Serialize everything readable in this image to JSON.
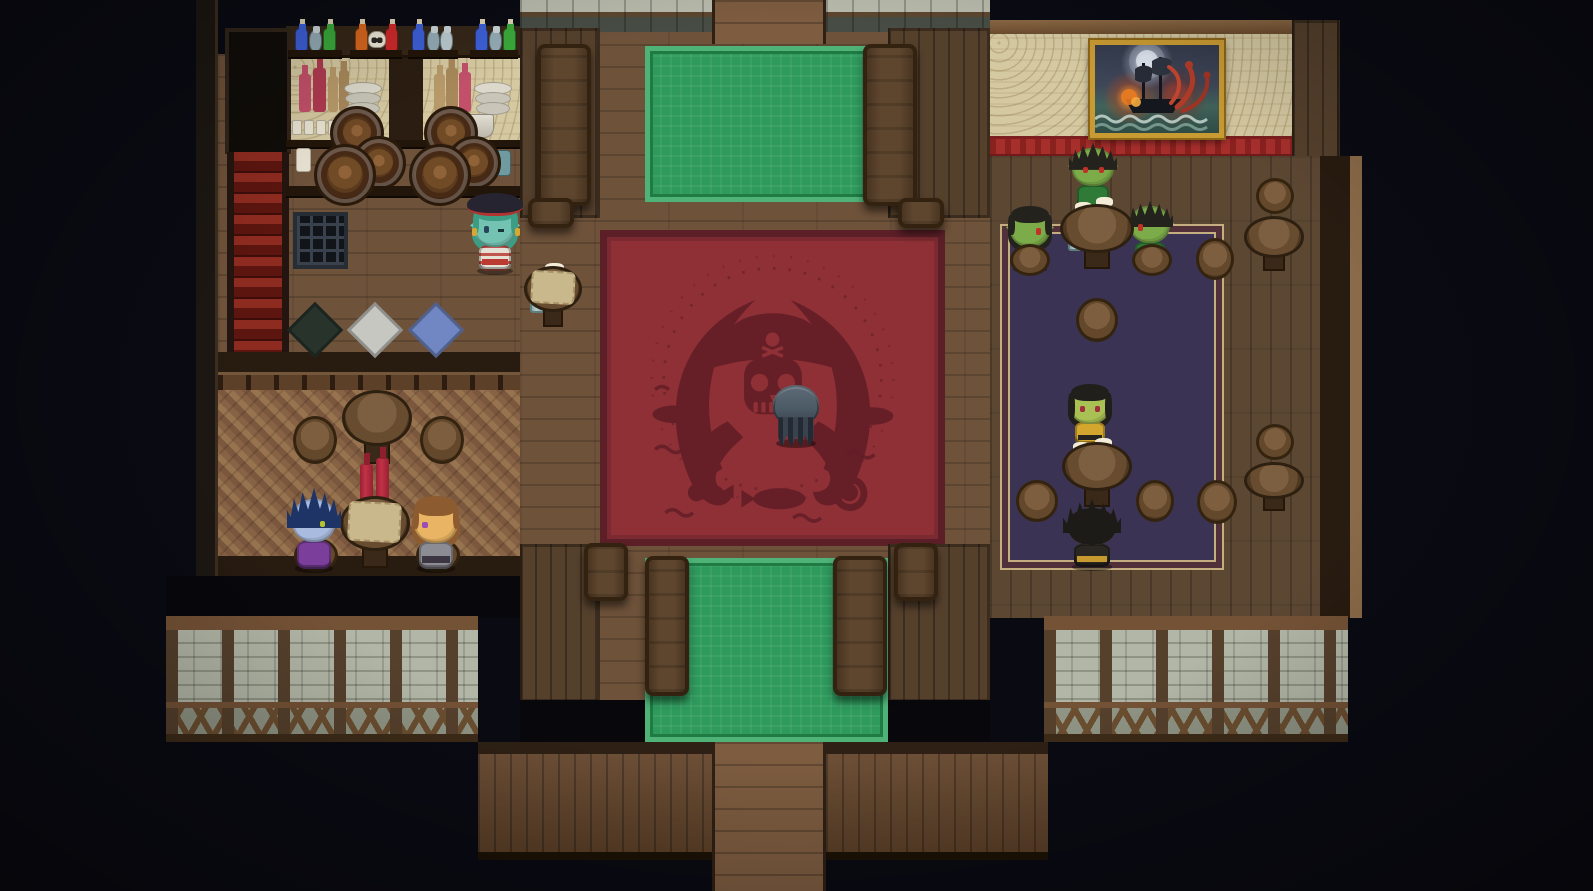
{
  "scene": {
    "setting": "pirate tavern interior",
    "style": "top-down 16-bit RPG pixel art",
    "width": 1593,
    "height": 891
  },
  "palette": {
    "background": "#0a0a13",
    "hall_floor": "#6e523a",
    "right_room_floor": "#5c4733",
    "wall_plank": "#55402c",
    "parquet": "#8a6545",
    "carpet_green": "#2e9a5c",
    "carpet_green_border": "#4fb277",
    "carpet_red": "#8e3036",
    "carpet_red_motif": "#621d26",
    "carpet_purple": "#3b3353",
    "carpet_purple_trim": "#c4ad7f",
    "wallpaper_tan": "#d5c9a2",
    "red_stripe": "#a62f2c",
    "stone_wall": "#a9ae9e",
    "stairs_red": "#8e2b20",
    "gold_frame": "#c89a32",
    "mug_body": "#9bb7b9",
    "mug_foam": "#f2ecd8"
  },
  "carpets": {
    "red_rug_motif": "pirate skull wearing a tricorn hat over crossed cutlasses, surrounded by tentacles, fish and waves",
    "green_rugs": "two ornate green runner rugs under the long mess tables",
    "purple_rug": "dark violet rug with tan double border in the goblin taproom"
  },
  "right_room": {
    "painting": {
      "subject": "galleon attacked by a red kraken on a stormy night sea",
      "frame": "#c89a32",
      "x": 1090,
      "y": 40,
      "w": 134,
      "h": 98
    }
  },
  "regions": [
    {
      "name": "hall-floor",
      "cls": "floor-h",
      "x": 520,
      "y": 0,
      "w": 470,
      "h": 744
    },
    {
      "name": "hall-walkway-top",
      "cls": "walkway",
      "x": 712,
      "y": 0,
      "w": 114,
      "h": 44,
      "inter": true
    },
    {
      "name": "stone-ledge-left",
      "cls": "stonetop",
      "x": 520,
      "y": 0,
      "w": 192,
      "h": 32
    },
    {
      "name": "stone-ledge-right",
      "cls": "stonetop",
      "x": 826,
      "y": 0,
      "w": 164,
      "h": 32
    },
    {
      "name": "hall-wall-top-left",
      "cls": "wallv",
      "x": 520,
      "y": 28,
      "w": 80,
      "h": 190
    },
    {
      "name": "hall-wall-top-right",
      "cls": "wallv",
      "x": 888,
      "y": 28,
      "w": 102,
      "h": 190
    },
    {
      "name": "green-carpet-top",
      "cls": "carpet-green",
      "x": 645,
      "y": 46,
      "w": 240,
      "h": 156
    },
    {
      "name": "left-room-floor",
      "cls": "floor-h",
      "x": 218,
      "y": 54,
      "w": 302,
      "h": 302
    },
    {
      "name": "bar-wallpaper",
      "cls": "wallpaper",
      "x": 286,
      "y": 58,
      "w": 234,
      "h": 88
    },
    {
      "name": "bar-pillar",
      "cls": "darkwood",
      "x": 389,
      "y": 56,
      "w": 34,
      "h": 92
    },
    {
      "name": "potion-shelf",
      "cls": "shelfdark",
      "x": 286,
      "y": 26,
      "w": 234,
      "h": 32
    },
    {
      "name": "left-edge-beam",
      "cls": "framedark",
      "x": 196,
      "y": 0,
      "w": 22,
      "h": 618
    },
    {
      "name": "stairs-doorway",
      "cls": "doorway",
      "x": 225,
      "y": 28,
      "w": 66,
      "h": 126,
      "inter": true
    },
    {
      "name": "red-staircase",
      "cls": "stairs",
      "x": 227,
      "y": 152,
      "w": 62,
      "h": 222,
      "inter": true
    },
    {
      "name": "left-divider",
      "cls": "darkband",
      "x": 218,
      "y": 352,
      "w": 302,
      "h": 22
    },
    {
      "name": "left-railing",
      "cls": "railing",
      "x": 218,
      "y": 372,
      "w": 302,
      "h": 20
    },
    {
      "name": "parquet-floor",
      "cls": "parquet",
      "x": 218,
      "y": 390,
      "w": 302,
      "h": 172
    },
    {
      "name": "left-room-bottom",
      "cls": "darkband",
      "x": 218,
      "y": 556,
      "w": 302,
      "h": 22
    },
    {
      "name": "left-room-shadow",
      "cls": "blackout",
      "x": 166,
      "y": 576,
      "w": 354,
      "h": 42
    },
    {
      "name": "red-carpet",
      "cls": "carpet-red",
      "x": 600,
      "y": 230,
      "w": 345,
      "h": 316
    },
    {
      "name": "hall-wall-bottom-left",
      "cls": "wallv",
      "x": 520,
      "y": 544,
      "w": 80,
      "h": 158
    },
    {
      "name": "hall-wall-bottom-right",
      "cls": "wallv",
      "x": 888,
      "y": 544,
      "w": 102,
      "h": 158
    },
    {
      "name": "green-carpet-bottom",
      "cls": "carpet-green",
      "x": 645,
      "y": 558,
      "w": 243,
      "h": 184
    },
    {
      "name": "void-bottom-left",
      "cls": "blackout",
      "x": 520,
      "y": 700,
      "w": 125,
      "h": 44
    },
    {
      "name": "void-bottom-right",
      "cls": "blackout",
      "x": 888,
      "y": 700,
      "w": 102,
      "h": 44
    },
    {
      "name": "right-beam-top",
      "cls": "beam",
      "x": 990,
      "y": 20,
      "w": 340,
      "h": 16
    },
    {
      "name": "right-wallpaper",
      "cls": "wallpaper",
      "x": 990,
      "y": 34,
      "w": 302,
      "h": 104
    },
    {
      "name": "right-wood-corner",
      "cls": "wallv",
      "x": 1292,
      "y": 20,
      "w": 48,
      "h": 140
    },
    {
      "name": "right-red-stripe",
      "cls": "redstripe",
      "x": 990,
      "y": 136,
      "w": 302,
      "h": 22
    },
    {
      "name": "right-room-floor",
      "cls": "floor-v",
      "x": 990,
      "y": 156,
      "w": 330,
      "h": 462
    },
    {
      "name": "right-wall-edge",
      "cls": "darkband",
      "x": 1320,
      "y": 156,
      "w": 30,
      "h": 462
    },
    {
      "name": "right-edge-light",
      "cls": "framelight",
      "x": 1350,
      "y": 156,
      "w": 12,
      "h": 462
    },
    {
      "name": "purple-carpet",
      "cls": "carpet-purple",
      "x": 1000,
      "y": 224,
      "w": 224,
      "h": 346
    },
    {
      "name": "stone-wall-left",
      "cls": "stonewall",
      "x": 166,
      "y": 616,
      "w": 312,
      "h": 126
    },
    {
      "name": "stone-wall-right",
      "cls": "stonewall",
      "x": 1044,
      "y": 616,
      "w": 304,
      "h": 126
    },
    {
      "name": "plank-wall-left",
      "cls": "plankwall",
      "x": 478,
      "y": 742,
      "w": 234,
      "h": 118
    },
    {
      "name": "plank-wall-right",
      "cls": "plankwall",
      "x": 826,
      "y": 742,
      "w": 222,
      "h": 118
    },
    {
      "name": "exit-walkway",
      "cls": "walkway",
      "x": 712,
      "y": 742,
      "w": 114,
      "h": 149,
      "inter": true
    }
  ],
  "entities": [
    {
      "t": "board",
      "x": 288,
      "y": 50,
      "w": 54,
      "h": 9
    },
    {
      "t": "board",
      "x": 350,
      "y": 50,
      "w": 52,
      "h": 9
    },
    {
      "t": "board",
      "x": 408,
      "y": 50,
      "w": 50,
      "h": 9
    },
    {
      "t": "board",
      "x": 470,
      "y": 50,
      "w": 48,
      "h": 9
    },
    {
      "t": "potion",
      "x": 295,
      "y": 28,
      "c": "#3d5fd6"
    },
    {
      "t": "jug",
      "x": 309,
      "y": 30,
      "c": "#93aab4"
    },
    {
      "t": "potion",
      "x": 323,
      "y": 28,
      "c": "#3aa83a"
    },
    {
      "t": "potion",
      "x": 355,
      "y": 28,
      "c": "#d6661e"
    },
    {
      "t": "skull",
      "x": 368,
      "y": 31
    },
    {
      "t": "potion",
      "x": 385,
      "y": 28,
      "c": "#cc2a2a"
    },
    {
      "t": "potion",
      "x": 412,
      "y": 28,
      "c": "#3d5fd6"
    },
    {
      "t": "jug",
      "x": 427,
      "y": 30,
      "c": "#93aab4"
    },
    {
      "t": "jug",
      "x": 440,
      "y": 30,
      "c": "#b9c9cd"
    },
    {
      "t": "potion",
      "x": 475,
      "y": 28,
      "c": "#3d5fd6"
    },
    {
      "t": "jug",
      "x": 489,
      "y": 30,
      "c": "#93aab4"
    },
    {
      "t": "potion",
      "x": 503,
      "y": 28,
      "c": "#3aa83a"
    },
    {
      "t": "bottle",
      "x": 299,
      "y": 74,
      "w": 12,
      "h": 38,
      "c": "#c2506a"
    },
    {
      "t": "bottle",
      "x": 313,
      "y": 68,
      "w": 13,
      "h": 44,
      "c": "#b03a50"
    },
    {
      "t": "bottle",
      "x": 328,
      "y": 76,
      "w": 10,
      "h": 36,
      "c": "#b89a6a"
    },
    {
      "t": "bottle",
      "x": 339,
      "y": 70,
      "w": 10,
      "h": 42,
      "c": "#a8885a"
    },
    {
      "t": "plates",
      "x": 344,
      "y": 82,
      "w": 40,
      "h": 34
    },
    {
      "t": "bottle",
      "x": 434,
      "y": 74,
      "w": 11,
      "h": 38,
      "c": "#b89a6a"
    },
    {
      "t": "bottle",
      "x": 446,
      "y": 68,
      "w": 12,
      "h": 44,
      "c": "#a8885a"
    },
    {
      "t": "bottle",
      "x": 459,
      "y": 72,
      "w": 12,
      "h": 40,
      "c": "#c2506a"
    },
    {
      "t": "plates",
      "x": 474,
      "y": 82,
      "w": 40,
      "h": 34
    },
    {
      "t": "smug",
      "x": 292,
      "y": 120
    },
    {
      "t": "smug",
      "x": 304,
      "y": 120
    },
    {
      "t": "smug",
      "x": 316,
      "y": 120
    },
    {
      "t": "smug",
      "x": 328,
      "y": 120
    },
    {
      "t": "smug",
      "x": 340,
      "y": 120
    },
    {
      "t": "bucket",
      "x": 468,
      "y": 114,
      "w": 26,
      "h": 24
    },
    {
      "t": "board",
      "x": 286,
      "y": 140,
      "w": 234,
      "h": 9
    },
    {
      "t": "jar",
      "x": 296,
      "y": 148,
      "w": 15,
      "h": 24
    },
    {
      "t": "can",
      "x": 487,
      "y": 150,
      "w": 24,
      "h": 26,
      "c": "#6f9aa0"
    },
    {
      "t": "barrel",
      "x": 330,
      "y": 106,
      "s": 54
    },
    {
      "t": "barrel",
      "x": 424,
      "y": 106,
      "s": 54
    },
    {
      "t": "barrel",
      "x": 352,
      "y": 136,
      "s": 54
    },
    {
      "t": "barrel",
      "x": 447,
      "y": 136,
      "s": 54
    },
    {
      "t": "barrel",
      "x": 314,
      "y": 144,
      "s": 62
    },
    {
      "t": "barrel",
      "x": 409,
      "y": 144,
      "s": 62
    },
    {
      "t": "board",
      "x": 286,
      "y": 186,
      "w": 234,
      "h": 12
    },
    {
      "t": "grate",
      "x": 293,
      "y": 212,
      "w": 55,
      "h": 57
    },
    {
      "t": "mat",
      "x": 295,
      "y": 310,
      "c": "#28332c"
    },
    {
      "t": "mat",
      "x": 355,
      "y": 310,
      "c": "#c7c7c1"
    },
    {
      "t": "mat",
      "x": 416,
      "y": 310,
      "c": "#7187c3"
    },
    {
      "t": "table",
      "x": 524,
      "y": 266,
      "w": 58,
      "h": 64,
      "cloth": "#c9b88c"
    },
    {
      "t": "mug",
      "x": 545,
      "y": 268,
      "w": 17,
      "h": 28,
      "f": true
    },
    {
      "t": "mug",
      "x": 530,
      "y": 290,
      "w": 15,
      "h": 23,
      "f": false
    },
    {
      "t": "ltable",
      "x": 537,
      "y": 44,
      "w": 54,
      "h": 162
    },
    {
      "t": "ltable",
      "x": 863,
      "y": 44,
      "w": 54,
      "h": 162
    },
    {
      "t": "ltable",
      "x": 528,
      "y": 198,
      "w": 46,
      "h": 30
    },
    {
      "t": "ltable",
      "x": 898,
      "y": 198,
      "w": 46,
      "h": 30
    },
    {
      "t": "ltable",
      "x": 645,
      "y": 556,
      "w": 44,
      "h": 140
    },
    {
      "t": "ltable",
      "x": 833,
      "y": 556,
      "w": 54,
      "h": 140
    },
    {
      "t": "ltable",
      "x": 584,
      "y": 543,
      "w": 44,
      "h": 58
    },
    {
      "t": "ltable",
      "x": 894,
      "y": 543,
      "w": 44,
      "h": 58
    },
    {
      "t": "table",
      "x": 342,
      "y": 390,
      "w": 70,
      "h": 78
    },
    {
      "t": "stool",
      "x": 293,
      "y": 416,
      "w": 44,
      "h": 48
    },
    {
      "t": "stool",
      "x": 420,
      "y": 416,
      "w": 44,
      "h": 48
    },
    {
      "t": "stool",
      "x": 294,
      "y": 538,
      "w": 44,
      "h": 34
    },
    {
      "t": "stool",
      "x": 416,
      "y": 538,
      "w": 44,
      "h": 34
    },
    {
      "t": "table",
      "x": 340,
      "y": 496,
      "w": 70,
      "h": 76,
      "cloth": "#c9b88c"
    },
    {
      "t": "rbottle",
      "x": 360,
      "y": 464,
      "w": 13,
      "h": 46
    },
    {
      "t": "rbottle",
      "x": 376,
      "y": 458,
      "w": 13,
      "h": 52
    },
    {
      "t": "table",
      "x": 1060,
      "y": 204,
      "w": 74,
      "h": 68
    },
    {
      "t": "mug",
      "x": 1075,
      "y": 207,
      "w": 15,
      "h": 26,
      "f": true
    },
    {
      "t": "mug",
      "x": 1096,
      "y": 202,
      "w": 15,
      "h": 28,
      "f": true
    },
    {
      "t": "mug",
      "x": 1068,
      "y": 226,
      "w": 14,
      "h": 25,
      "f": false
    },
    {
      "t": "mug",
      "x": 1090,
      "y": 229,
      "w": 15,
      "h": 27,
      "f": true
    },
    {
      "t": "stool",
      "x": 1010,
      "y": 244,
      "w": 40,
      "h": 32
    },
    {
      "t": "stool",
      "x": 1132,
      "y": 244,
      "w": 40,
      "h": 32
    },
    {
      "t": "stool",
      "x": 1196,
      "y": 238,
      "w": 38,
      "h": 42
    },
    {
      "t": "stool",
      "x": 1076,
      "y": 298,
      "w": 42,
      "h": 44
    },
    {
      "t": "table",
      "x": 1062,
      "y": 442,
      "w": 70,
      "h": 68
    },
    {
      "t": "mug",
      "x": 1073,
      "y": 447,
      "w": 15,
      "h": 28,
      "f": true
    },
    {
      "t": "mug",
      "x": 1095,
      "y": 443,
      "w": 15,
      "h": 30,
      "f": true
    },
    {
      "t": "mug",
      "x": 1085,
      "y": 465,
      "w": 16,
      "h": 30,
      "f": true
    },
    {
      "t": "stool",
      "x": 1016,
      "y": 480,
      "w": 42,
      "h": 42
    },
    {
      "t": "stool",
      "x": 1136,
      "y": 480,
      "w": 38,
      "h": 42
    },
    {
      "t": "stool",
      "x": 1197,
      "y": 480,
      "w": 40,
      "h": 44
    },
    {
      "t": "stool",
      "x": 1256,
      "y": 178,
      "w": 38,
      "h": 36
    },
    {
      "t": "table",
      "x": 1244,
      "y": 216,
      "w": 60,
      "h": 58
    },
    {
      "t": "stool",
      "x": 1256,
      "y": 424,
      "w": 38,
      "h": 36
    },
    {
      "t": "table",
      "x": 1244,
      "y": 462,
      "w": 60,
      "h": 52
    }
  ],
  "characters": [
    {
      "id": "bartender-pirate",
      "x": 470,
      "y": 202,
      "w": 50,
      "h": 72,
      "skin": "#74c2b2",
      "hair": "#3d9c84",
      "hair_style": "long",
      "eyes": "#27465e",
      "outfit": "#e6e1d4",
      "accent": "#bb3b33",
      "stripes": true,
      "hat": "#262430",
      "hat_trim": "#b23432",
      "earrings": "#d8a830",
      "ears": true,
      "facing": "down",
      "wink": true,
      "desc": "Teal-skinned pirate bartender with black tricorn hat, sea-green hair, winking, striped shirt"
    },
    {
      "id": "patron-blue-elf",
      "x": 288,
      "y": 494,
      "w": 52,
      "h": 78,
      "skin": "#a9bcdf",
      "hair": "#1e3467",
      "hair_style": "spiky-big",
      "eyes": "#b5c32e",
      "outfit": "#7b3f9b",
      "ears": true,
      "facing": "right",
      "desc": "Blue-skinned elf with tall dark-blue spiky hair and purple coat, seated facing right"
    },
    {
      "id": "patron-adventurer",
      "x": 410,
      "y": 496,
      "w": 52,
      "h": 76,
      "skin": "#e9b463",
      "hair": "#8c5c30",
      "hair_style": "wavy",
      "eyes": "#9a4cb2",
      "outfit": "#8c8c94",
      "accent": "#3c3642",
      "facing": "left",
      "desc": "Tan-skinned adventurer with brown hair, violet eyes and grey armor, seated facing left"
    },
    {
      "id": "goblin-patron-north",
      "x": 1068,
      "y": 144,
      "w": 50,
      "h": 68,
      "skin": "#7cab49",
      "hair": "#24221d",
      "hair_style": "spiky",
      "eyes": "#c03226",
      "outfit": "#2e7a36",
      "ears": true,
      "facing": "down",
      "desc": "Green-skinned goblin with black spiky hair, red eyes and green cloak, standing north of the table"
    },
    {
      "id": "goblin-patron-west",
      "x": 1006,
      "y": 206,
      "w": 48,
      "h": 66,
      "skin": "#7cab49",
      "hair": "#24221d",
      "hair_style": "long",
      "eyes": "#c03226",
      "outfit": "#2e7a36",
      "ears": true,
      "facing": "right",
      "desc": "Green-skinned goblin seated west of the table facing right"
    },
    {
      "id": "goblin-patron-east",
      "x": 1126,
      "y": 202,
      "w": 48,
      "h": 66,
      "skin": "#7cab49",
      "hair": "#24221d",
      "hair_style": "spiky",
      "eyes": "#c03226",
      "outfit": "#2e7a36",
      "ears": true,
      "facing": "left",
      "desc": "Green-skinned goblin seated east of the table facing left"
    },
    {
      "id": "goblin-woman",
      "x": 1066,
      "y": 384,
      "w": 48,
      "h": 64,
      "skin": "#a9c054",
      "hair": "#211f1c",
      "hair_style": "bob",
      "eyes": "#a22d3c",
      "outfit": "#d3a62e",
      "accent": "#27241f",
      "facing": "down",
      "desc": "Green-skinned woman with black bob hair and yellow-black dress at the lower table"
    },
    {
      "id": "spiky-haired-patron",
      "x": 1064,
      "y": 504,
      "w": 56,
      "h": 66,
      "skin": "#caa05a",
      "hair": "#1d1b18",
      "hair_style": "spiky-big",
      "outfit": "#2a2723",
      "accent": "#c69a2e",
      "facing": "up",
      "desc": "Patron with large black spiky hair and dark gold-trimmed clothes, back turned"
    },
    {
      "id": "hooded-tentacled-figure",
      "x": 770,
      "y": 384,
      "w": 52,
      "h": 64,
      "type": "creature",
      "body": "#4c5a66",
      "fringe": "#232a33",
      "facing": "down",
      "desc": "Small hooded grey creature with a tentacle fringe standing on the pirate rug"
    }
  ]
}
